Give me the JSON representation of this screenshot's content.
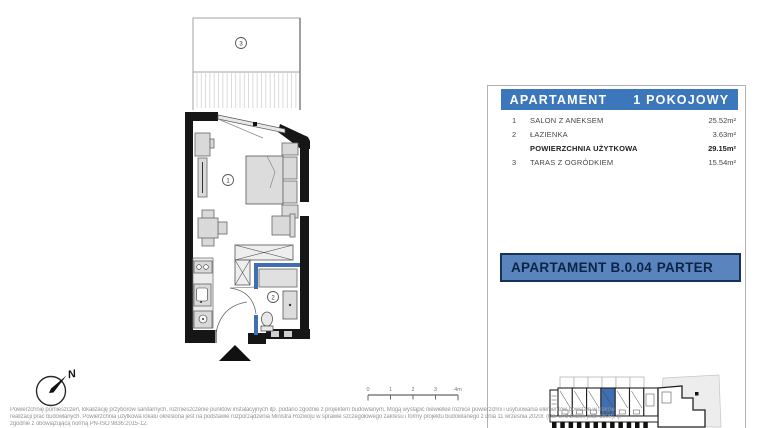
{
  "floor_plan": {
    "salon_number": "1",
    "bathroom_number": "2",
    "terrace_number": "3"
  },
  "unit_table": {
    "header": {
      "left": "APARTAMENT",
      "right": "1 POKOJOWY"
    },
    "rows": [
      {
        "num": "1",
        "label": "SALON Z ANEKSEM",
        "area": "25.52m²"
      },
      {
        "num": "2",
        "label": "ŁAZIENKA",
        "area": "3.63m²"
      },
      {
        "num": "",
        "label": "POWIERZCHNIA UŻYTKOWA",
        "area": "29.15m²"
      },
      {
        "num": "3",
        "label": "TARAS Z OGRÓDKIEM",
        "area": "15.54m²"
      }
    ]
  },
  "unit_banner": {
    "name": "APARTAMENT B.0.04",
    "floor": "PARTER"
  },
  "compass": {
    "north_label": "N"
  },
  "scale_bar": {
    "ticks": [
      "0",
      "1",
      "2",
      "3",
      "4m"
    ]
  },
  "disclaimer": {
    "line1": "Powierzchnię pomieszczeń, lokalizację przyborów sanitarnych, rozmieszczenie punktów instalacyjnych itp. podano zgodnie z projektem budowlanym. Mogą wystąpić niewielkie różnice powierzchni i usytuowania elementów powstałe w trakcie",
    "line2": "realizacji prac budowlanych. Powierzchnia użytkowa lokalu określona jest na podstawie rozporządzenia Ministra Rozwoju w sprawie szczegółowego zakresu i formy projektu budowlanego z dnia 11 września 2020r. (Dz. U. z 2020r. poz. 1609), tj.",
    "line3": "zgodnie z obowiązującą normą PN-ISO 9836:2015-12."
  },
  "colors": {
    "header_blue": "#3d77bb",
    "banner_blue": "#5a84bd",
    "banner_border": "#16325a",
    "banner_text": "#0c2446",
    "highlight_blue": "#3f6fb2",
    "wall_black": "#161616"
  }
}
